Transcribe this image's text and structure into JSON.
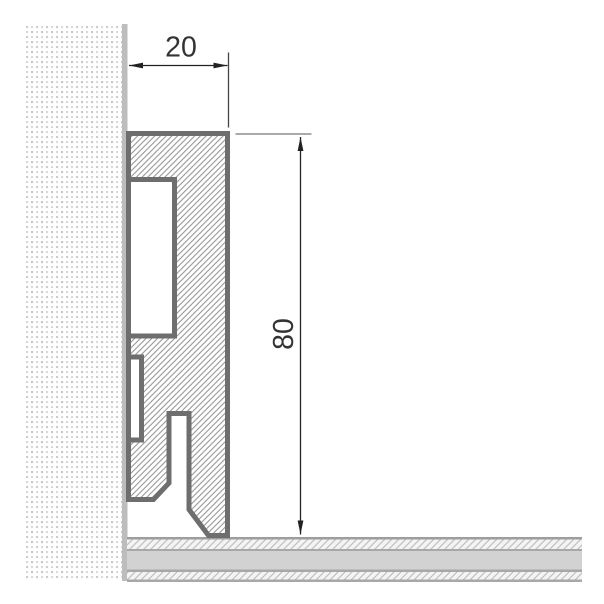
{
  "drawing": {
    "title": "Skirting profile cross-section",
    "view": "Side section: wall, 20x80 skirting profile, floor build-up"
  },
  "dimensions": {
    "width_mm": {
      "label": "20"
    },
    "height_mm": {
      "label": "80"
    }
  },
  "colors": {
    "profile_outline": "#6e6e6e",
    "profile_hatch_lines": "#8e8e8e",
    "wall_finish_strip": "#bdbdbd",
    "wall_dot_dark": "#c6c6c6",
    "wall_dot_light": "#dadada",
    "floor_core_band": "#d2d2d2",
    "floor_hatch_lines": "#c0c0c0",
    "floor_divider_lines": "#a5a5a5",
    "dimension_line": "#222222",
    "dimension_text": "#333333"
  },
  "components": {
    "wall": "dotted wall section",
    "wall_finish": "wall finish layer",
    "profile": "hatched skirting profile section",
    "floor": "three-layer floor section"
  }
}
